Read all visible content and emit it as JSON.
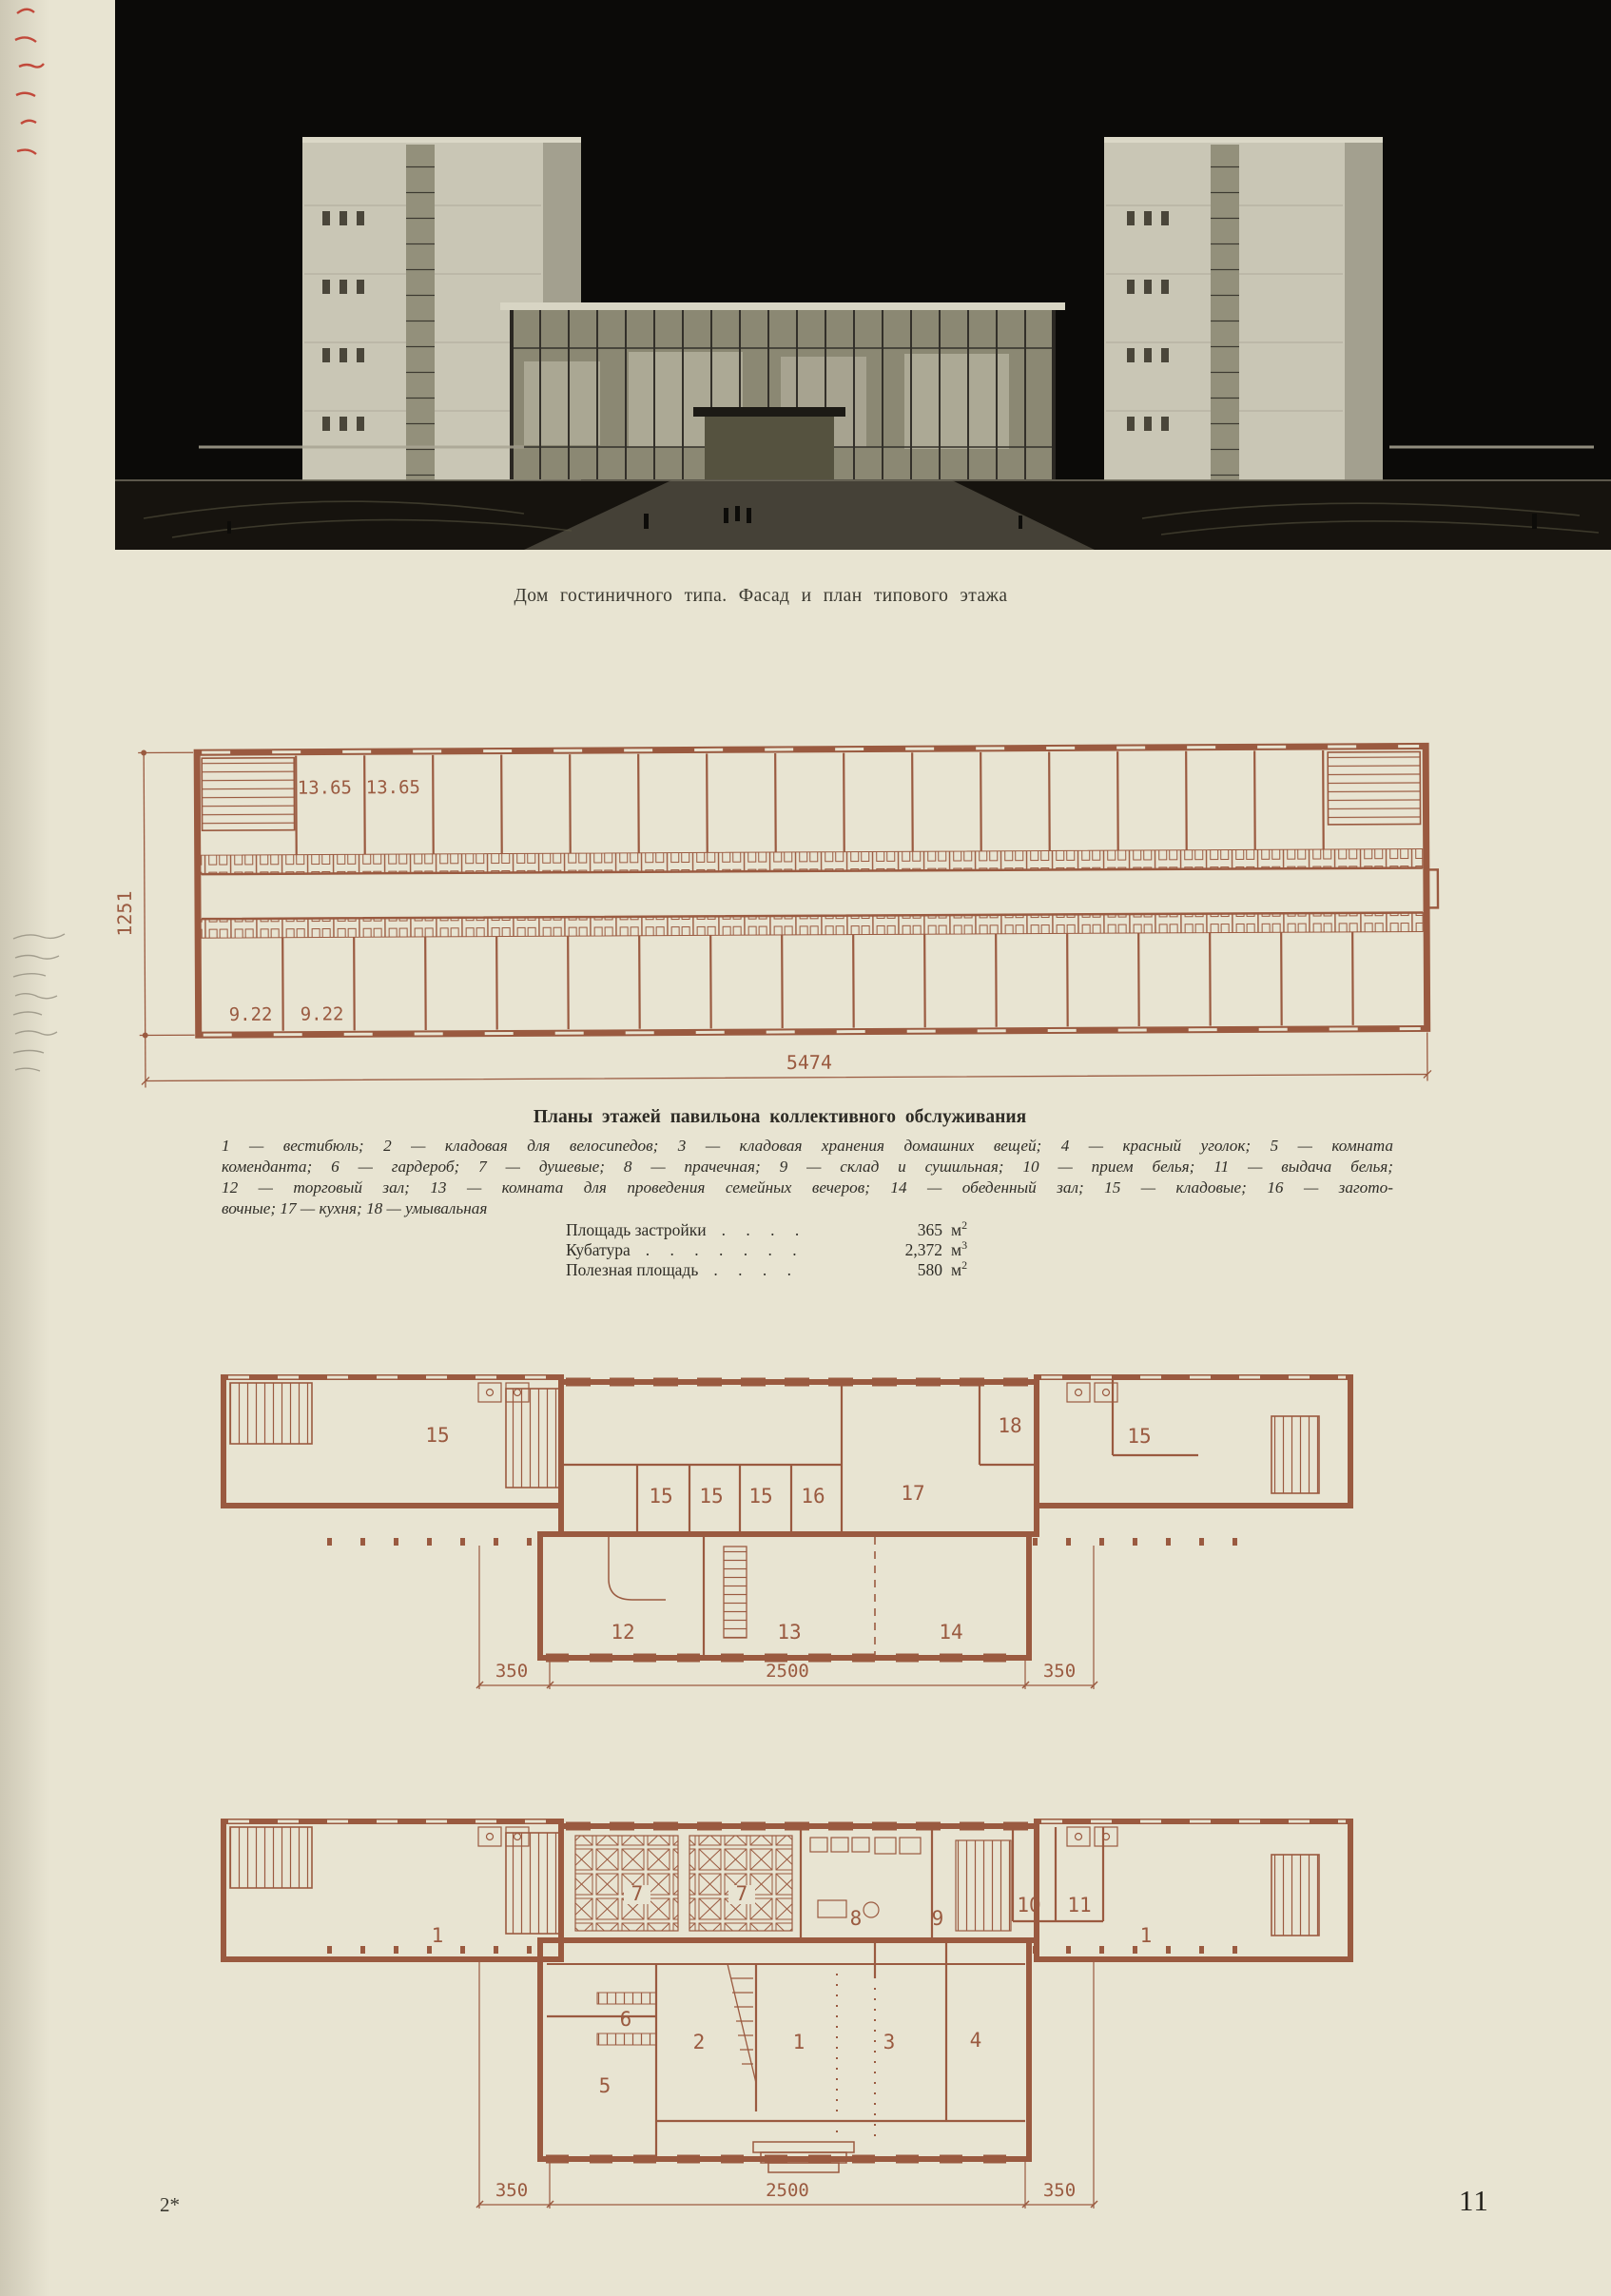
{
  "page": {
    "paper_color": "#e8e4d2",
    "ink_color": "#2f2d27",
    "plan_ink_color": "#9a5a40",
    "footer_mark": "2*",
    "page_number": "11"
  },
  "photo": {
    "caption": "Дом гостиничного типа. Фасад и план типового этажа"
  },
  "typical_plan": {
    "room_labels": [
      "13.65",
      "13.65",
      "9.22",
      "9.22"
    ],
    "height_dim": "1251",
    "width_dim": "5474"
  },
  "pavilion": {
    "heading": "Планы этажей павильона коллективного обслуживания",
    "legend": [
      "1 — вестибюль; 2 — кладовая для велосипедов; 3 — кладовая хранения домашних вещей; 4 — красный уголок; 5 — комната",
      "коменданта; 6 — гардероб; 7 — душевые; 8 — прачечная; 9 — склад и сушильная; 10 — прием белья; 11 — выдача белья;",
      "12 — торговый зал; 13 — комната для проведения семейных вечеров; 14 — обеденный зал; 15 — кладовые; 16 — загото-",
      "вочные; 17 — кухня; 18 — умывальная"
    ],
    "stats": [
      {
        "label": "Площадь застройки",
        "dots": ". . . .",
        "value": "365",
        "unit": "м",
        "power": "2"
      },
      {
        "label": "Кубатура",
        "dots": ". . . . . . .",
        "value": "2,372",
        "unit": "м",
        "power": "3"
      },
      {
        "label": "Полезная площадь",
        "dots": ". . . .",
        "value": "580",
        "unit": "м",
        "power": "2"
      }
    ],
    "upper_plan": {
      "labels": [
        "15",
        "15",
        "15",
        "15",
        "16",
        "17",
        "18",
        "15",
        "12",
        "13",
        "14"
      ],
      "dims": [
        "350",
        "2500",
        "350"
      ]
    },
    "ground_plan": {
      "labels": [
        "1",
        "7",
        "7",
        "8",
        "9",
        "10",
        "11",
        "1",
        "6",
        "2",
        "1",
        "3",
        "4",
        "5"
      ],
      "dims": [
        "350",
        "2500",
        "350"
      ]
    }
  }
}
